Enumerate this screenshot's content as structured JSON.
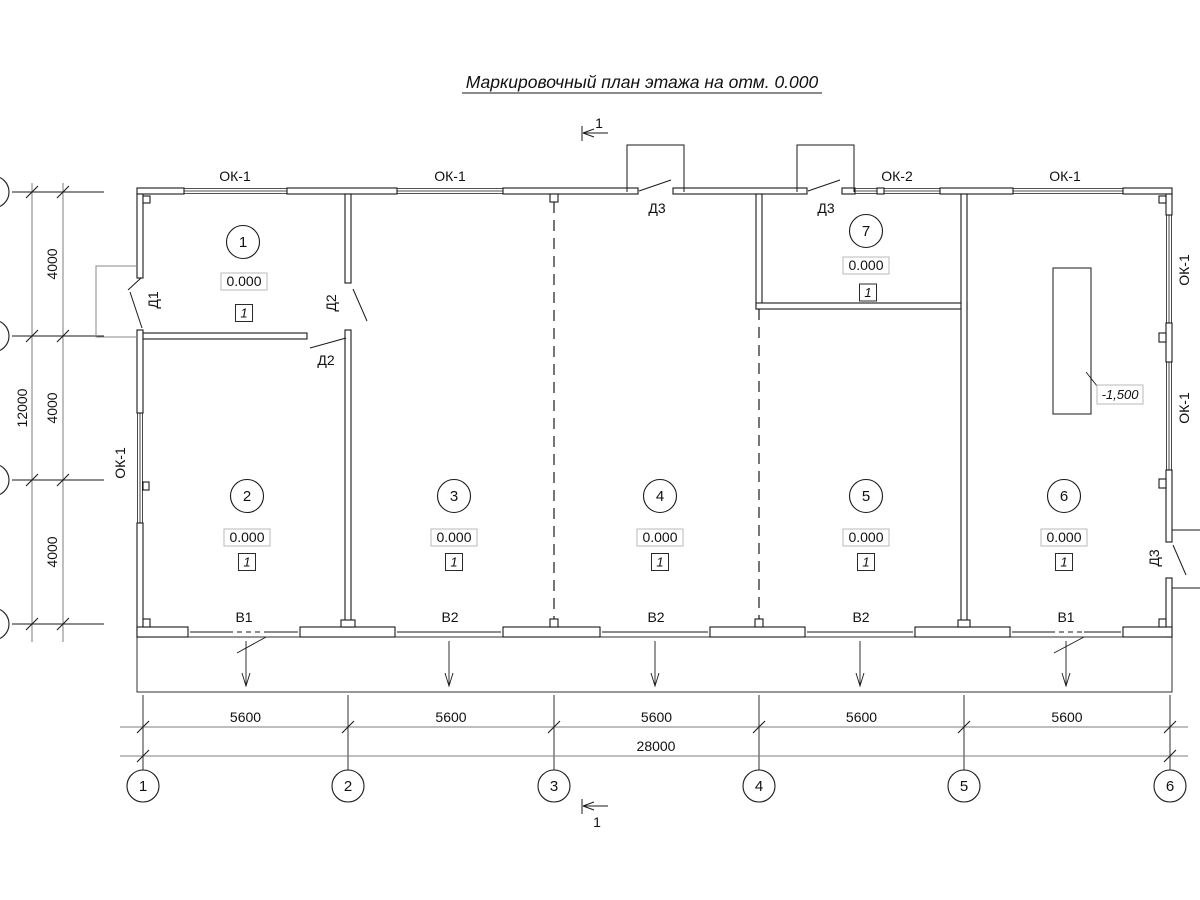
{
  "title": "Маркировочный план этажа на отм. 0.000",
  "section": {
    "label": "1"
  },
  "axes": {
    "bottom": [
      "1",
      "2",
      "3",
      "4",
      "5",
      "6"
    ]
  },
  "dims": {
    "bottom": {
      "spans": [
        "5600",
        "5600",
        "5600",
        "5600",
        "5600"
      ],
      "total": "28000"
    },
    "left": {
      "spans": [
        "4000",
        "4000",
        "4000"
      ],
      "total": "12000"
    }
  },
  "rooms": [
    {
      "number": "1",
      "elevation": "0.000",
      "floor_type": "1"
    },
    {
      "number": "2",
      "elevation": "0.000",
      "floor_type": "1"
    },
    {
      "number": "3",
      "elevation": "0.000",
      "floor_type": "1"
    },
    {
      "number": "4",
      "elevation": "0.000",
      "floor_type": "1"
    },
    {
      "number": "5",
      "elevation": "0.000",
      "floor_type": "1"
    },
    {
      "number": "6",
      "elevation": "0.000",
      "floor_type": "1"
    },
    {
      "number": "7",
      "elevation": "0.000",
      "floor_type": "1"
    }
  ],
  "windows": {
    "top": [
      "ОК-1",
      "ОК-1",
      "ОК-2",
      "ОК-1"
    ],
    "left": "ОК-1",
    "right": [
      "ОК-1",
      "ОК-1"
    ]
  },
  "doors": {
    "d1": "Д1",
    "d2_wall": "Д2",
    "d2_room": "Д2",
    "d3_vest1": "Д3",
    "d3_vest2": "Д3",
    "d3_right": "Д3"
  },
  "gates": [
    "В1",
    "В2",
    "В2",
    "В2",
    "В1"
  ],
  "pit": {
    "elevation": "-1,500"
  },
  "colors": {
    "line": "#1a1a1a",
    "dimension": "#7d7d7d",
    "porch": "#8a8a8a",
    "elevation_box_border": "#b9b9b9"
  }
}
